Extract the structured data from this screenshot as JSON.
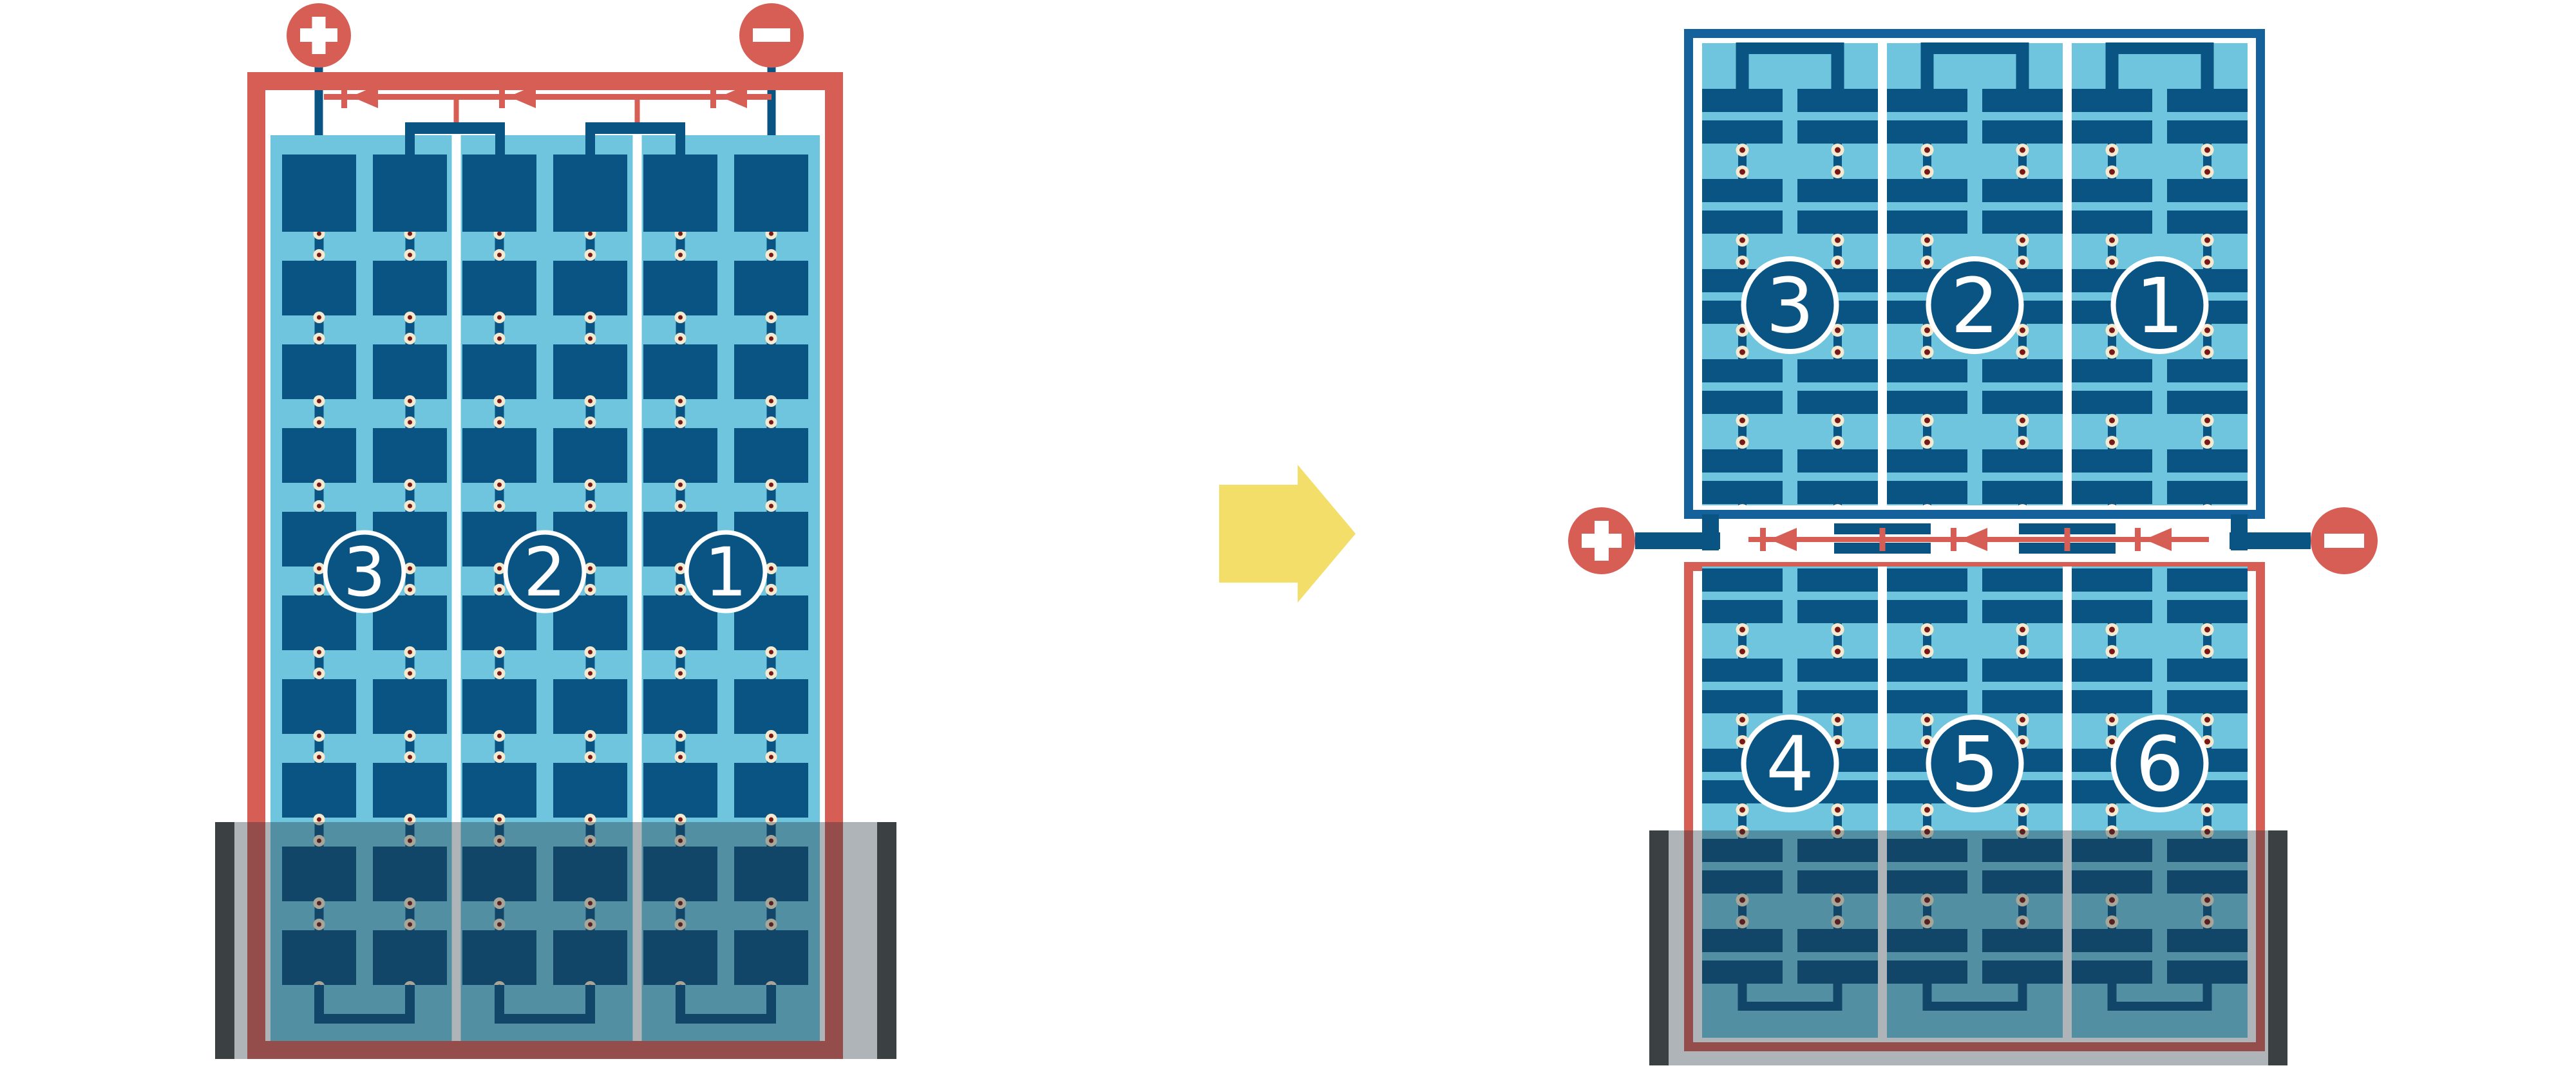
{
  "palette": {
    "red": "#D75E55",
    "panel_navy": "#0A5484",
    "frame_blue": "#15619B",
    "light_blue": "#6FC5DD",
    "dot_cream": "#F5EACF",
    "dot_maroon": "#7A1815",
    "divider_white": "#FFFFFF",
    "shade_overlay": "rgba(30,48,58,0.36)",
    "shade_bar": "#3B4043",
    "arrow_yellow": "#F2DE69",
    "background": "#FFFFFF"
  },
  "before_panel": {
    "terminals": {
      "positive": "+",
      "negative": "−"
    },
    "strings": [
      {
        "label": "3"
      },
      {
        "label": "2"
      },
      {
        "label": "1"
      }
    ]
  },
  "transition": {
    "arrow_direction": "right"
  },
  "after_assembly": {
    "terminals": {
      "positive": "+",
      "negative": "−"
    },
    "top_panel": {
      "strings": [
        {
          "label": "3"
        },
        {
          "label": "2"
        },
        {
          "label": "1"
        }
      ]
    },
    "bottom_panel": {
      "strings": [
        {
          "label": "4"
        },
        {
          "label": "5"
        },
        {
          "label": "6"
        }
      ]
    }
  }
}
